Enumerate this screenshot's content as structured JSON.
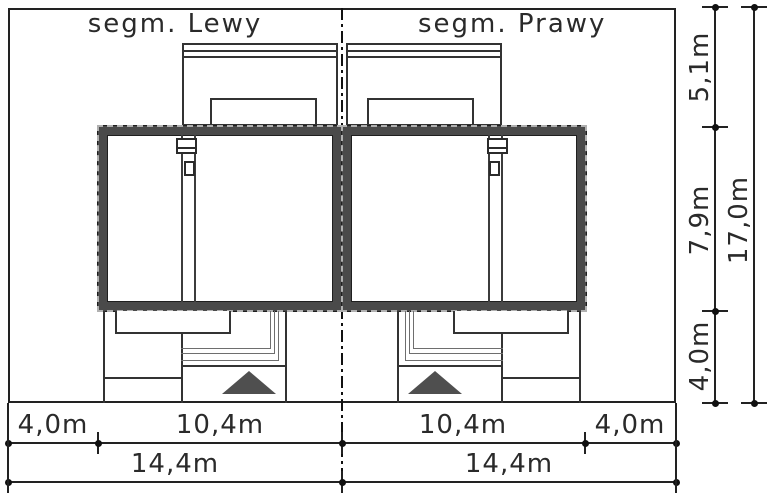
{
  "drawing": {
    "labels": {
      "left_segment": "segm. Lewy",
      "right_segment": "segm. Prawy"
    },
    "dimensions": {
      "bottom_row1": [
        "4,0m",
        "10,4m",
        "10,4m",
        "4,0m"
      ],
      "bottom_row2": [
        "14,4m",
        "14,4m"
      ],
      "right_col": [
        "5,1m",
        "7,9m",
        "4,0m"
      ],
      "right_total": "17,0m"
    },
    "colors": {
      "wall_fill": "#4a4a4a",
      "line": "#222222",
      "entrance_arrow": "#4f4f4f",
      "eaves_dash": "#b0b0b0"
    },
    "icons": {
      "entrance_arrow": "filled-triangle-up",
      "dimension_tick": "dot-with-cross"
    }
  }
}
